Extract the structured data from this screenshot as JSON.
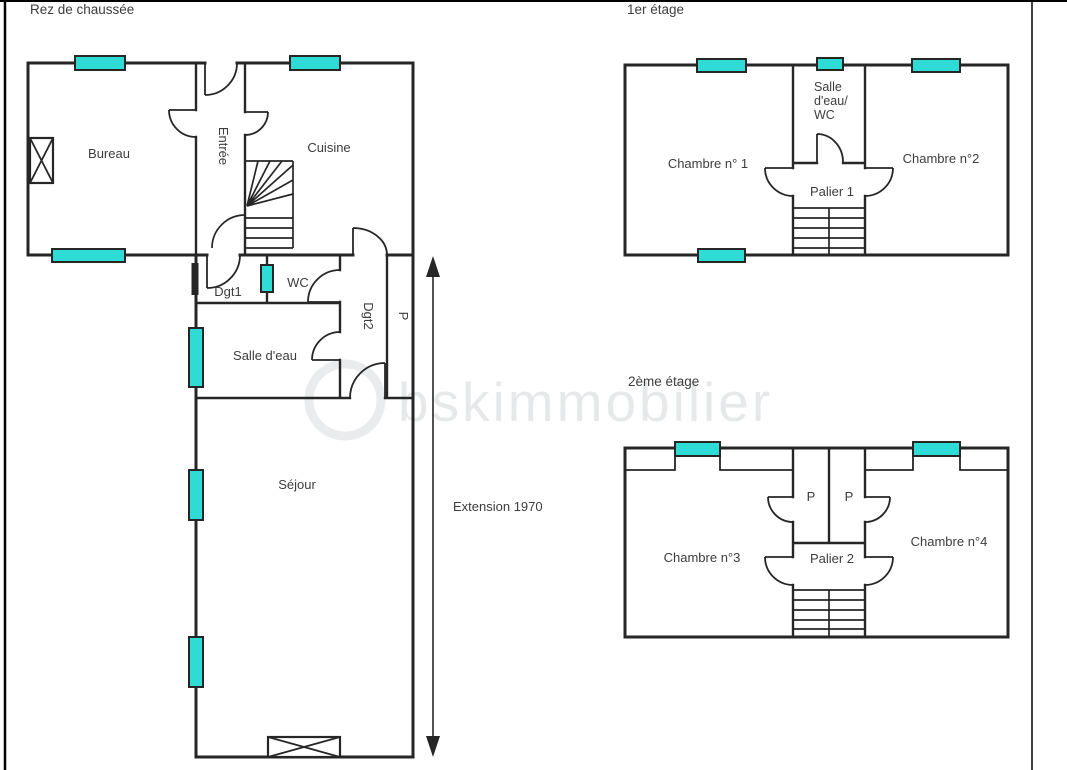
{
  "colors": {
    "wall": "#262626",
    "window_fill": "#2edcd5",
    "text": "#3d3d3d",
    "watermark": "#d3d7d9",
    "border": "#000000"
  },
  "watermark": {
    "text": "bskimmobilier"
  },
  "floors": {
    "ground": {
      "title": "Rez de chaussée",
      "rooms": {
        "bureau": "Bureau",
        "entree": "Entrée",
        "cuisine": "Cuisine",
        "dgt1": "Dgt1",
        "wc": "WC",
        "dgt2": "Dgt2",
        "placard": "P",
        "salle_deau": "Salle d'eau",
        "sejour": "Séjour"
      },
      "annotation": "Extension 1970"
    },
    "first": {
      "title": "1er étage",
      "rooms": {
        "chambre1": "Chambre n° 1",
        "salle_deau_wc": [
          "Salle",
          "d'eau/",
          "WC"
        ],
        "chambre2": "Chambre n°2",
        "palier": "Palier 1"
      }
    },
    "second": {
      "title": "2ème étage",
      "rooms": {
        "chambre3": "Chambre n°3",
        "placard_left": "P",
        "placard_right": "P",
        "palier": "Palier 2",
        "chambre4": "Chambre n°4"
      }
    }
  }
}
